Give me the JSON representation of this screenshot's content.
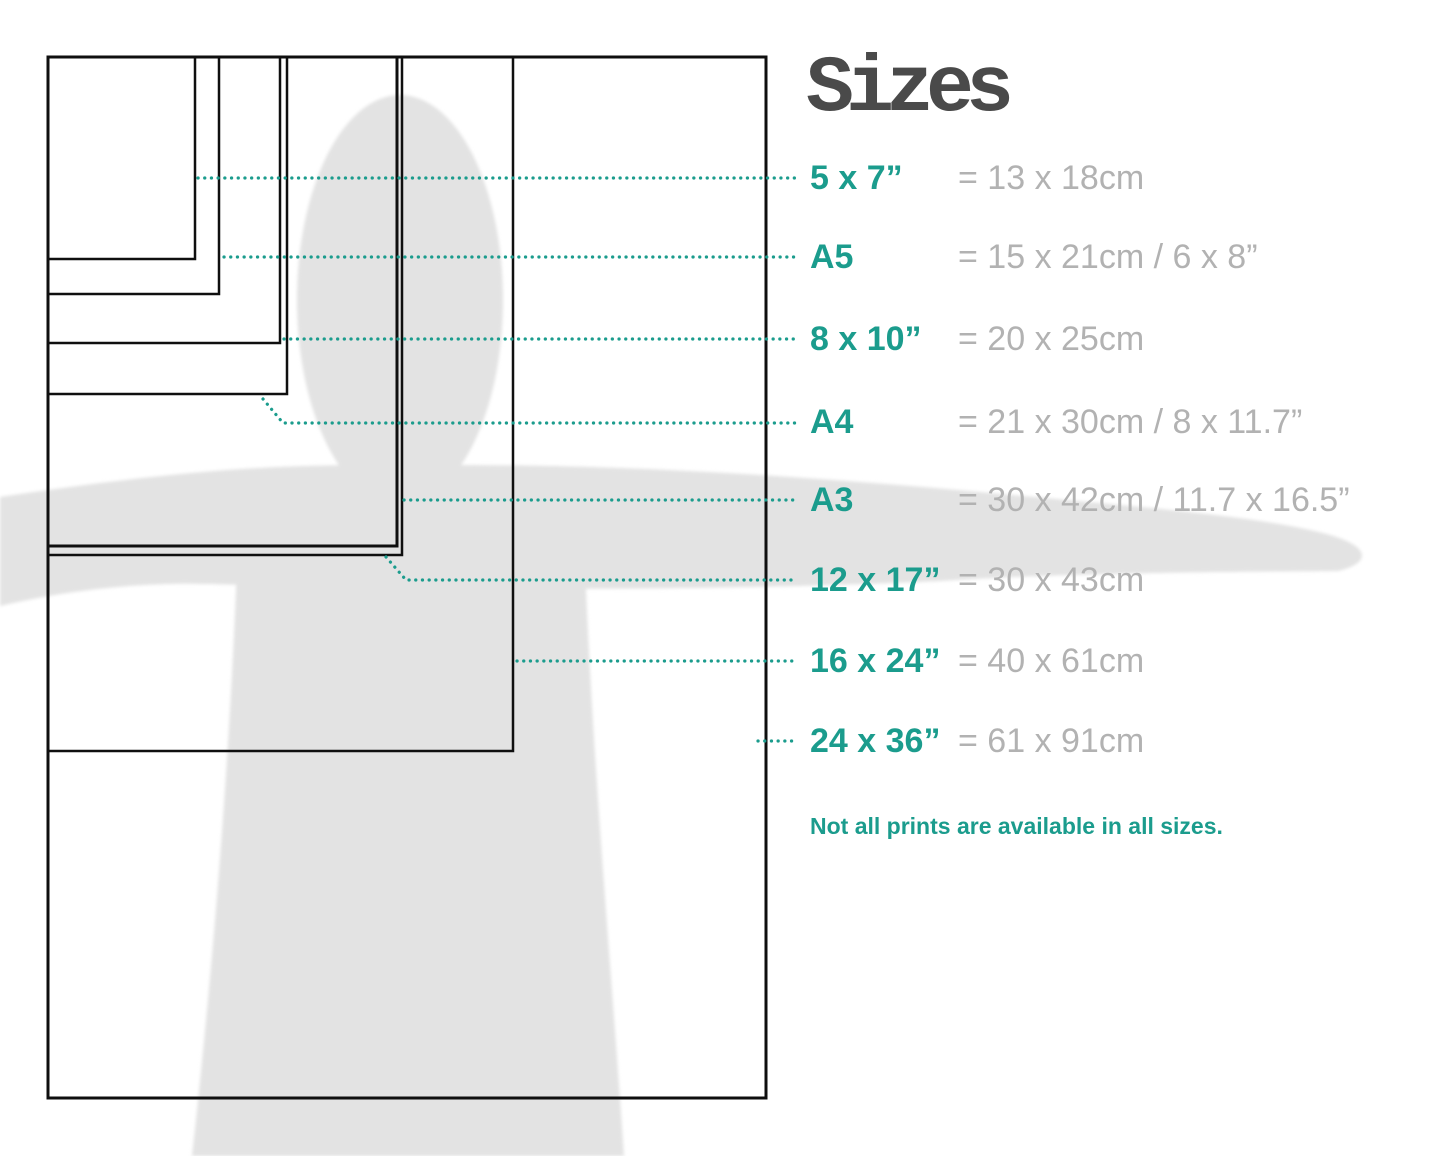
{
  "title": "Sizes",
  "sizes": [
    {
      "label": "5 x 7”",
      "metric": "= 13 x 18cm"
    },
    {
      "label": "A5",
      "metric": "= 15 x 21cm / 6 x 8”"
    },
    {
      "label": "8 x 10”",
      "metric": "= 20 x 25cm"
    },
    {
      "label": "A4",
      "metric": "= 21 x 30cm / 8 x 11.7”"
    },
    {
      "label": "A3",
      "metric": "= 30 x 42cm / 11.7 x 16.5”"
    },
    {
      "label": "12 x 17”",
      "metric": "= 30 x 43cm"
    },
    {
      "label": "16 x 24”",
      "metric": "= 40 x 61cm"
    },
    {
      "label": "24 x 36”",
      "metric": "= 61 x 91cm"
    }
  ],
  "note": "Not all prints are available in all sizes.",
  "colors": {
    "teal": "#1b9c8d",
    "value_gray": "#b2b2b2",
    "title_gray": "#4a4a4a",
    "silhouette_gray": "#e3e3e3",
    "outline_black": "#0f0f0f"
  }
}
